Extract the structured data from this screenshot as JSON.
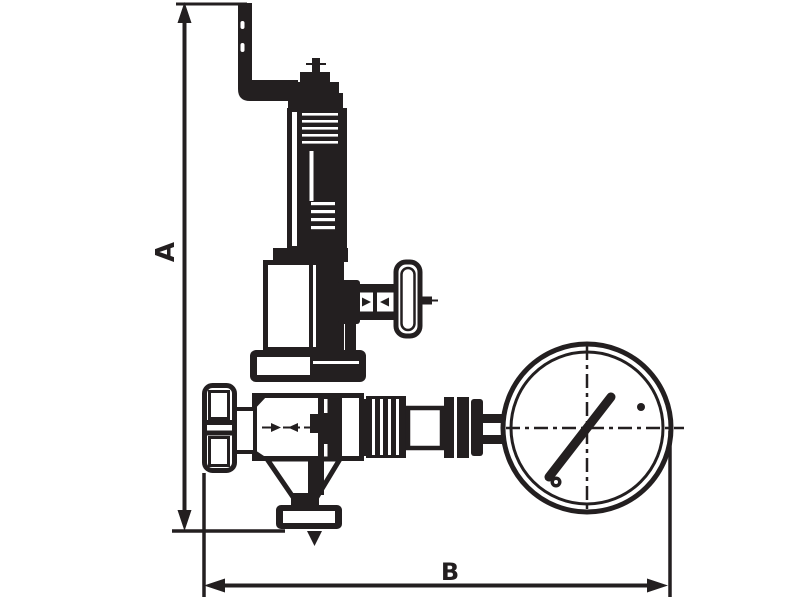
{
  "drawing": {
    "dimension_a_label": "A",
    "dimension_b_label": "B",
    "ink_color": "#231f20",
    "background_color": "#ffffff"
  }
}
